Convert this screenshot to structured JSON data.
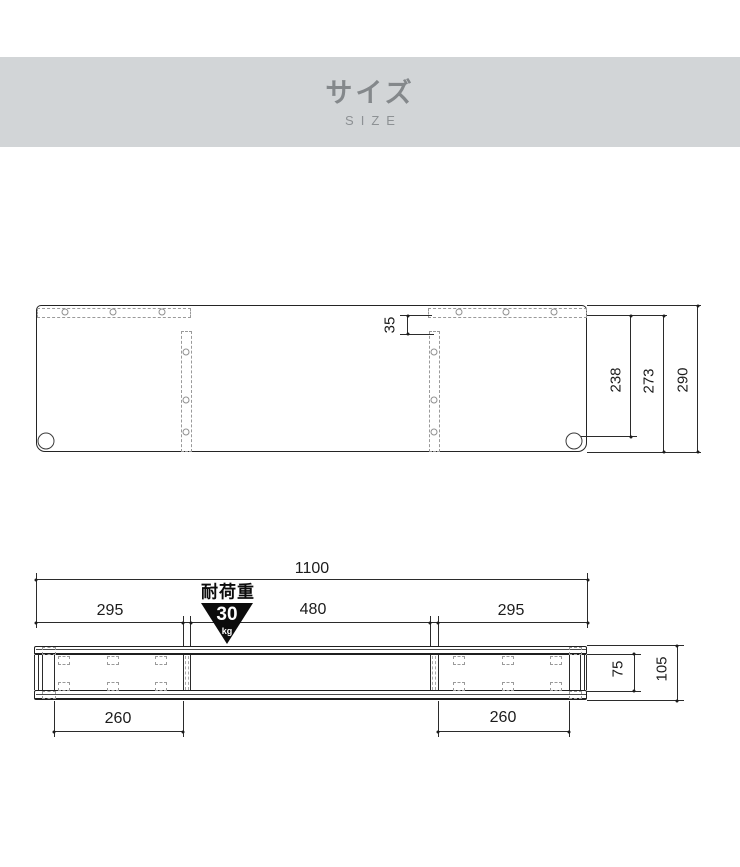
{
  "header": {
    "title": "サイズ",
    "subtitle": "SIZE"
  },
  "top_view": {
    "dims": {
      "hole_inset": "35",
      "hole_row_to_cord_hole": "238",
      "hole_row_to_front_edge": "273",
      "depth_total": "290"
    }
  },
  "front_view": {
    "dims": {
      "width_total": "1100",
      "section_left": "295",
      "section_center": "480",
      "section_right": "295",
      "leg_span_left": "260",
      "leg_span_right": "260",
      "opening_height": "75",
      "height_total": "105"
    },
    "load_badge": {
      "label": "耐荷重",
      "value": "30",
      "unit": "kg"
    }
  },
  "colors": {
    "banner_bg": "#d2d5d7",
    "banner_text": "#84888b",
    "line": "#2b2b2b",
    "dashed_line": "#9a9a9a",
    "badge_bg": "#0c0c0c",
    "badge_text": "#ffffff"
  }
}
